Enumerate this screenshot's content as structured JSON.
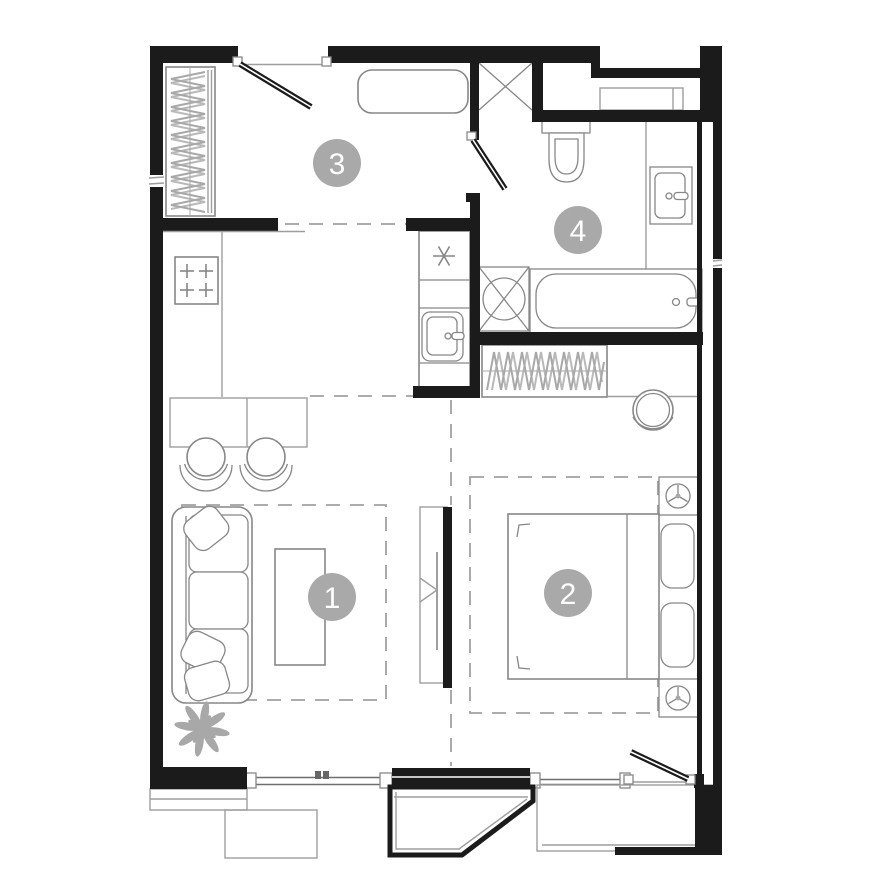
{
  "plan": {
    "rooms": [
      {
        "label": "1"
      },
      {
        "label": "2"
      },
      {
        "label": "3"
      },
      {
        "label": "4"
      }
    ],
    "colors": {
      "wall": "#1b1b1b",
      "furniture": "#878787",
      "light_line": "#9e9e9e",
      "hatch": "#a8a8a8",
      "dash": "#a0a0a0",
      "label_bg": "#a9a9a9",
      "label_text": "#ffffff"
    }
  }
}
